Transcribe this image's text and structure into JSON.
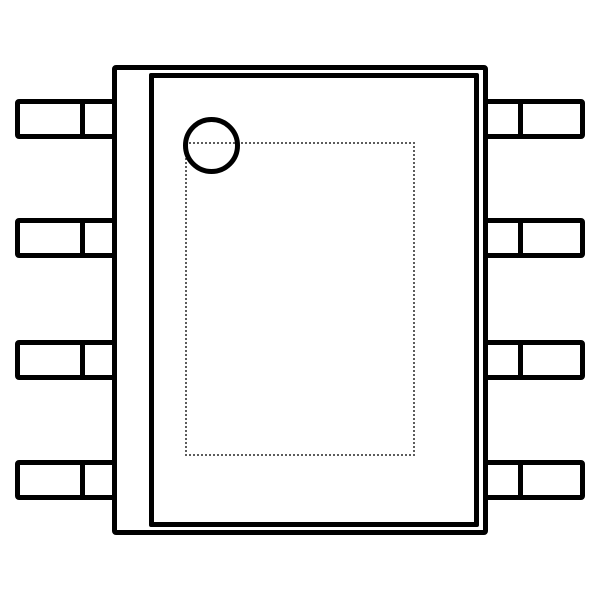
{
  "diagram": {
    "description": "8-pin IC package outline drawing, top view",
    "pin_count_total": 8,
    "pin_count_left": 4,
    "pin_count_right": 4,
    "pin1_marker_shape": "circle",
    "pad_outline_style": "dotted",
    "colors": {
      "line": "#000000",
      "dotted_outline": "#5c5c5c",
      "background": "#ffffff"
    }
  }
}
